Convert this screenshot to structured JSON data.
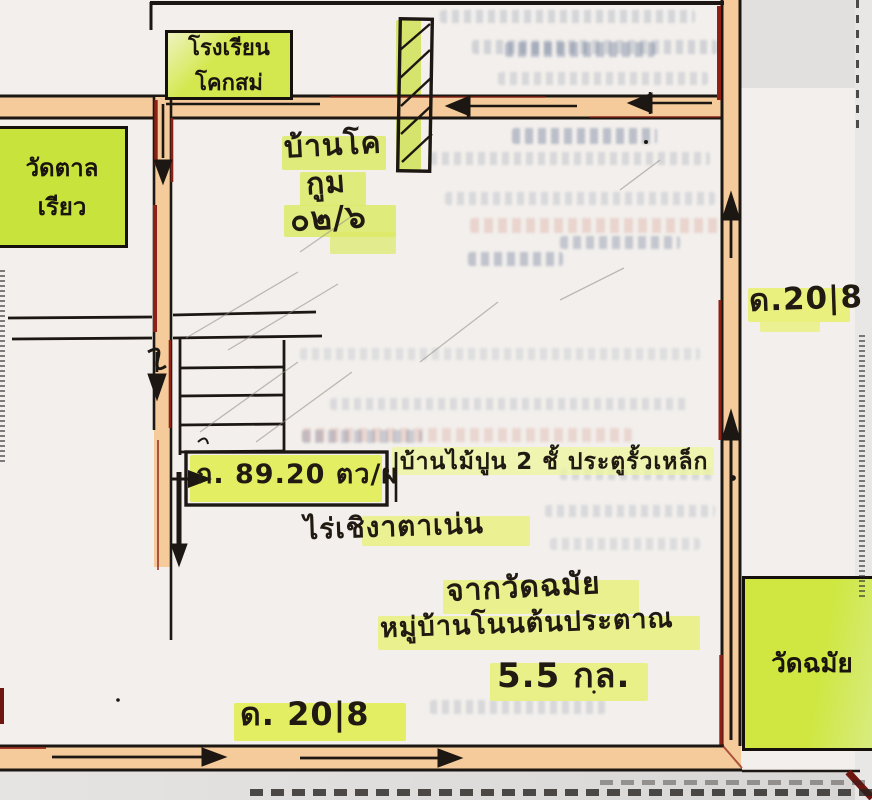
{
  "labels": {
    "school": {
      "line1": "โรงเรียน",
      "line2": "โคกสม่"
    },
    "temple_left": {
      "line1": "วัดตาล",
      "line2": "เรียว"
    },
    "ban_kho": {
      "line1": "บ้านโค",
      "line2": "กูม",
      "line3": "๐๒/๖"
    },
    "road_right_number": "ด.20|8",
    "road_bottom_number": "ด. 20|8",
    "plot_area": "ก. 89.20 ตว/ผ",
    "house_description": "บ้านไม้ปูน 2 ชั้ ประตูรั้วเหล็ก",
    "farm": "ไร่เชิงาตาเน่น",
    "route_from": "จากวัดฉมัย",
    "village": "หมู่บ้านโนนต้นประตาณ",
    "distance": "5.5 กล.",
    "temple_bottom_right": "วัดฉมัย"
  },
  "colors": {
    "paper": "#f2efec",
    "highlight_green_box": "#cfe544",
    "highlight_yellow": "#e9f07d",
    "road_orange": "#f5cb9b",
    "ink_black": "#1c1712",
    "ink_dark_red": "#8e2015",
    "bleedthrough_blue": "#7886a0",
    "bleedthrough_pink": "#d69688"
  }
}
